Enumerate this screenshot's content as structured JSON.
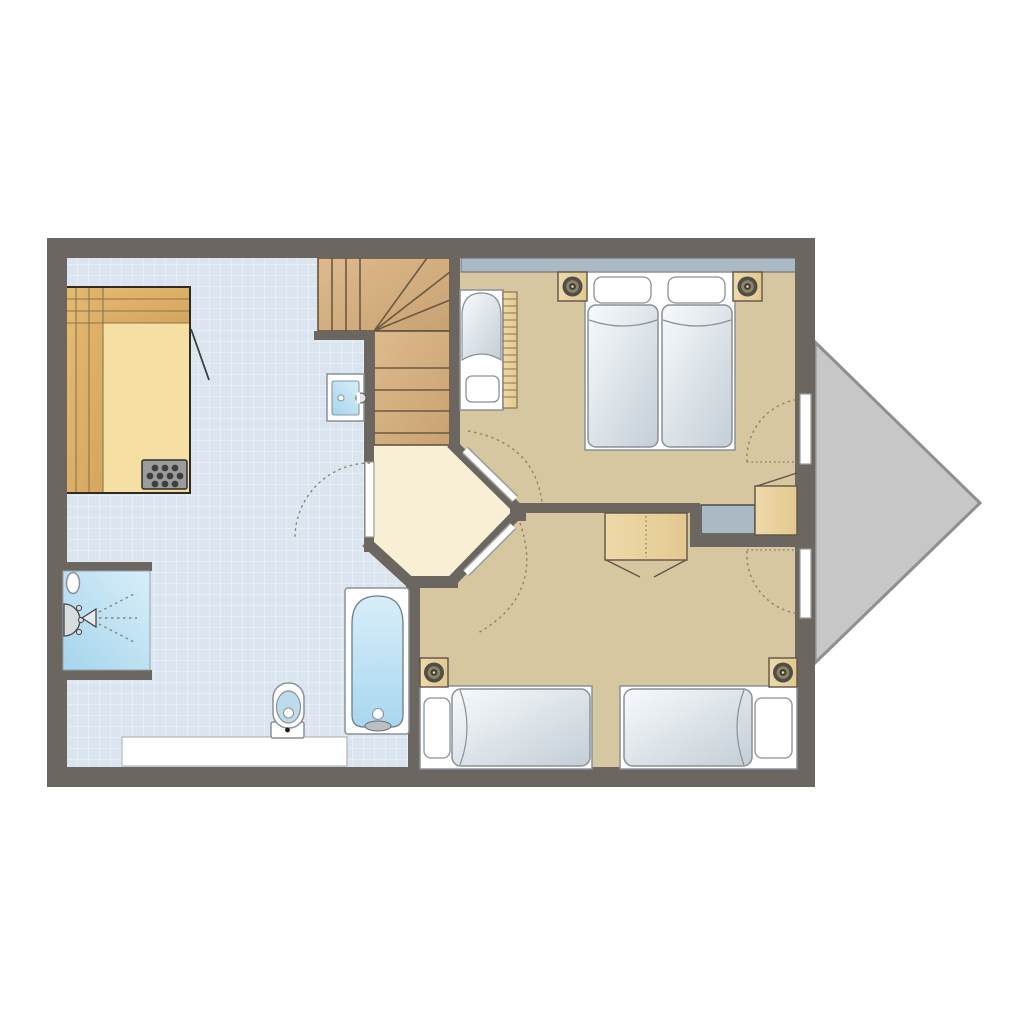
{
  "page": {
    "background": "#ffffff",
    "kind": "apartment-floor-plan",
    "orientation": "landscape"
  },
  "colors": {
    "wall": "#6c6661",
    "terrace_fill": "#c7c7c7",
    "terrace_edge": "#8f8f8f",
    "tile_base": "#dbe5ef",
    "tile_line": "#ffffff",
    "bedroom_floor": "#d6c7a0",
    "hall_floor": "#f9efd4",
    "window_glass": "#aab9c4",
    "glass_edge": "#5d666d",
    "stair_wood_light": "#ddba8c",
    "stair_wood_dark": "#c9a272",
    "stair_edge": "#5a4c3d",
    "stair_line": "#6b5a44",
    "bench_wood_light": "#e6bc72",
    "bench_wood_dark": "#d4a55e",
    "sauna_platform": "#f6dfa3",
    "sauna_edge": "#2e2a25",
    "furn_wood_light": "#eed9a9",
    "furn_wood_dark": "#e3c98f",
    "furn_edge": "#5f5548",
    "wood_line": "#8a744f",
    "heater_body": "#9c9c9c",
    "heater_dot": "#3f3f3f",
    "water_light": "#d8eef9",
    "water_dark": "#a5d5ec",
    "fixture_white": "#ffffff",
    "outline": "#8a9096",
    "dark_line": "#3f3f3f",
    "mattress_light": "#f7fafc",
    "mattress_shade": "#c3ced6",
    "lamp_outer": "#4e4e4e",
    "lamp_ring": "#8f8559",
    "lamp_dot": "#d6d6d6",
    "toilet_bowl": "#bcdcee",
    "arc": "#8c8270"
  },
  "floor_plan": {
    "rooms": [
      {
        "id": "bathroom",
        "floor": "light-blue-tile-grid",
        "fixtures": [
          "sauna-cabin",
          "sauna-heater",
          "shower-cabin",
          "shower-head",
          "toilet",
          "vanity-counter",
          "bathtub",
          "wall-sink"
        ]
      },
      {
        "id": "stairwell",
        "feature": "l-shaped-winder-staircase"
      },
      {
        "id": "hall",
        "floor": "cream",
        "doors": [
          "bathroom-door",
          "bedroom-top-door",
          "bedroom-bottom-door"
        ]
      },
      {
        "id": "bedroom-top",
        "floor": "tan",
        "furniture": [
          "double-bed",
          "pillow",
          "pillow",
          "nightstand-with-lamp",
          "nightstand-with-lamp",
          "baby-crib",
          "corner-cabinet",
          "utility-box",
          "window-strip",
          "terrace-door"
        ]
      },
      {
        "id": "bedroom-bottom",
        "floor": "tan",
        "furniture": [
          "single-bed",
          "single-bed",
          "nightstand-with-lamp",
          "nightstand-with-lamp",
          "wardrobe",
          "terrace-door"
        ]
      },
      {
        "id": "terrace",
        "shape": "triangle-bay"
      }
    ]
  }
}
